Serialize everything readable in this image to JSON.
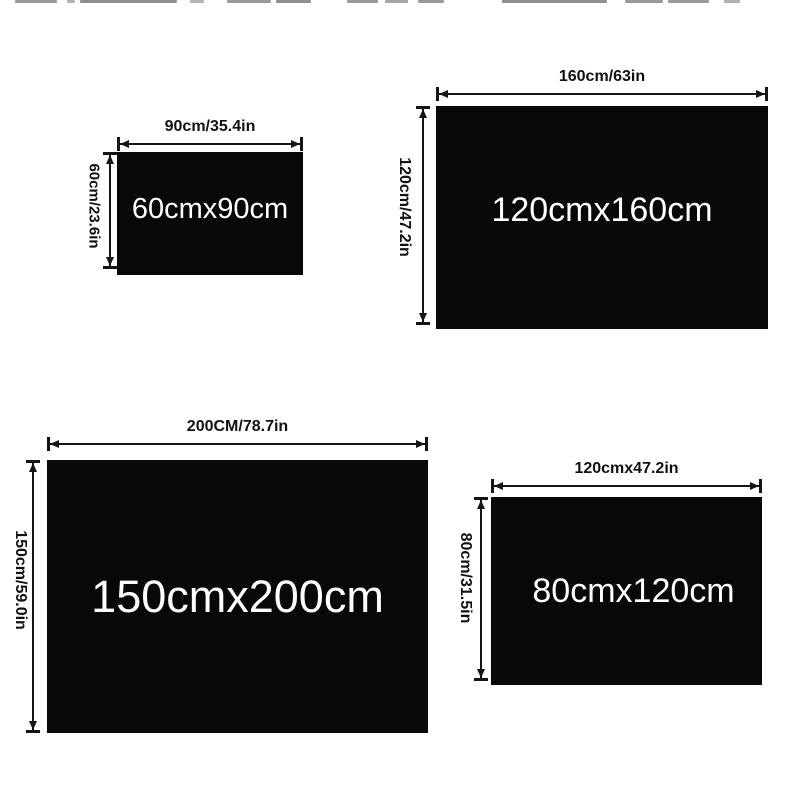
{
  "panels": [
    {
      "size": "60cmx90cm",
      "width_label": "90cm/35.4in",
      "height_label": "60cm/23.6in"
    },
    {
      "size": "120cmx160cm",
      "width_label": "160cm/63in",
      "height_label": "120cm/47.2in"
    },
    {
      "size": "150cmx200cm",
      "width_label": "200CM/78.7in",
      "height_label": "150cm/59.0in"
    },
    {
      "size": "80cmx120cm",
      "width_label": "120cmx47.2in",
      "height_label": "80cm/31.5in"
    }
  ],
  "colors": {
    "background": "#ffffff",
    "rect": "#080808",
    "label": "#111111",
    "size_text": "#ffffff",
    "dimension_line": "#151515"
  }
}
